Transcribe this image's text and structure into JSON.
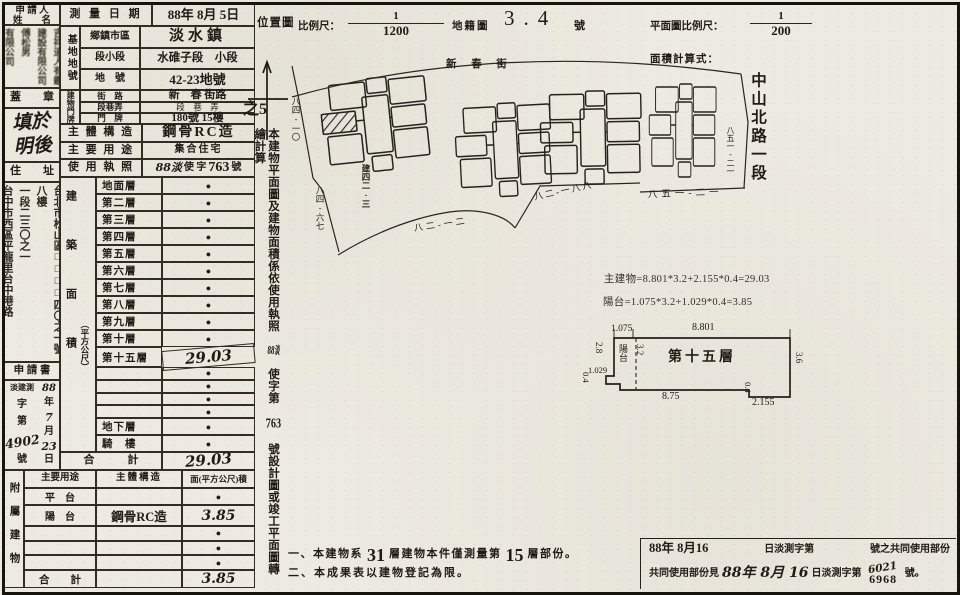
{
  "left": {
    "applicant_l1": "申 請 人",
    "applicant_l2": "姓　　名",
    "stamps": "吉祥道人有鑑\n建設有限公司傅松男\n有限公司",
    "seal": "蓋　　章",
    "fill_note": "填於\n明後",
    "address_label": "住　　址",
    "address": "台北市松山區□□□□四〇之一號八樓\n一段二三〇之一\n台中市西區平龍里台中港路",
    "app_title": "申 請 書",
    "app_prefix": "淡建測",
    "app_k1": "字",
    "app_k2": "第",
    "app_num": "4902",
    "app_k3": "號",
    "app_d1": "88",
    "app_d2": "年",
    "app_d3": "7",
    "app_d4": "月",
    "app_d5": "23",
    "app_d6": "日",
    "annex_side": "附屬建物"
  },
  "form": {
    "survey_label": "測 量 日 期",
    "survey_value": "88年 8月 5日",
    "site_group": "基地地號",
    "site_rows": [
      [
        "鄉鎮市區",
        "淡水鎮"
      ],
      [
        "段小段",
        "水碓子段　小段"
      ],
      [
        "地　號",
        "42-23地號"
      ]
    ],
    "door_group": "建物門牌",
    "door_rows": [
      [
        "街　路",
        "新　春 街路"
      ],
      [
        "段巷弄",
        "段　巷　弄"
      ],
      [
        "門　牌",
        "180號 15樓"
      ]
    ],
    "door_overflow": "之5",
    "structure_label": "主 體 構 造",
    "structure_value": "鋼骨RC造",
    "usage_label": "主 要 用 途",
    "usage_value": "集合住宅",
    "license_label": "使 用 執 照",
    "license_hand": "88淡",
    "license_mid": "使 字",
    "license_num": "763",
    "license_suffix": "號",
    "area_side": "建築面積",
    "area_side_unit": "（平方公尺）",
    "area_rows": [
      [
        "地面層",
        "●"
      ],
      [
        "第二層",
        "●"
      ],
      [
        "第三層",
        "●"
      ],
      [
        "第四層",
        "●"
      ],
      [
        "第五層",
        "●"
      ],
      [
        "第六層",
        "●"
      ],
      [
        "第七層",
        "●"
      ],
      [
        "第八層",
        "●"
      ],
      [
        "第九層",
        "●"
      ],
      [
        "第十層",
        "●"
      ],
      [
        "第十五層",
        "29.03"
      ],
      [
        "",
        "●"
      ],
      [
        "",
        "●"
      ],
      [
        "",
        "●"
      ],
      [
        "",
        "●"
      ],
      [
        "地下層",
        "●"
      ],
      [
        "騎　樓",
        "●"
      ]
    ],
    "area_total_label": "合　　　計",
    "area_total_value": "29.03",
    "annex_headers": [
      "主要用途",
      "主體構造",
      "面(平方公尺)積"
    ],
    "annex_rows": [
      [
        "平　台",
        "",
        "●"
      ],
      [
        "陽　台",
        "鋼骨RC造",
        "3.85"
      ],
      [
        "",
        "",
        "●"
      ],
      [
        "",
        "",
        "●"
      ],
      [
        "",
        "",
        "●"
      ]
    ],
    "annex_total_label": "合　　計",
    "annex_total_struct": "",
    "annex_total_value": "3.85"
  },
  "strip": {
    "pre": "本建物平面圖及建物面積係依使用執照",
    "hand1": "88淡",
    "mid": "使字第",
    "hand2": "763",
    "post": "號設計圖或竣工平面圖轉繪計算"
  },
  "top": {
    "loc": "位置圖",
    "scale_lbl": "比例尺：",
    "num": "1",
    "den": "1200",
    "cad": "地籍圖",
    "map_no": "3.4",
    "map_no_unit": "號",
    "plan_lbl": "平面圖比例尺：",
    "pnum": "1",
    "pden": "200",
    "formula_lbl": "面積計算式：",
    "street_v": "中山北路一段"
  },
  "map": {
    "street": "新 春 街",
    "l1": "八四-一〇",
    "l2": "八四-六七",
    "l3": "建四二-三",
    "l4": "八二-一二",
    "l5": "八二-一八八",
    "l6": "八五一-二一",
    "l7": "八五一-二一"
  },
  "plan": {
    "f1": "主建物=8.801*3.2+2.155*0.4=29.03",
    "f2": "陽台=1.075*3.2+1.029*0.4=3.85",
    "room": "第十五層",
    "balcony": "陽台",
    "d1": "1.075",
    "d2": "8.801",
    "d3": "2.8",
    "d4": "3.2",
    "d5": "1.029",
    "d6": "0.4",
    "d7": "8.75",
    "d8": "0.4",
    "d9": "2.155",
    "d10": "3.6"
  },
  "notes": {
    "n1a": "一、本建物系",
    "n1b": "31",
    "n1c": "層建物本件僅測量第",
    "n1d": "15",
    "n1e": "層部份。",
    "n2": "二、本成果表以建物登記為限。"
  },
  "footer": {
    "l1a": "88年 8月16",
    "l1b": "日淡測字第",
    "l1c": "號之共同使用部份",
    "l2a": "共同使用部份見",
    "l2b": "88年 8月 16",
    "l2c": "日淡測字第",
    "hand": "6021",
    "printno": "6968",
    "l2d": "號。"
  }
}
